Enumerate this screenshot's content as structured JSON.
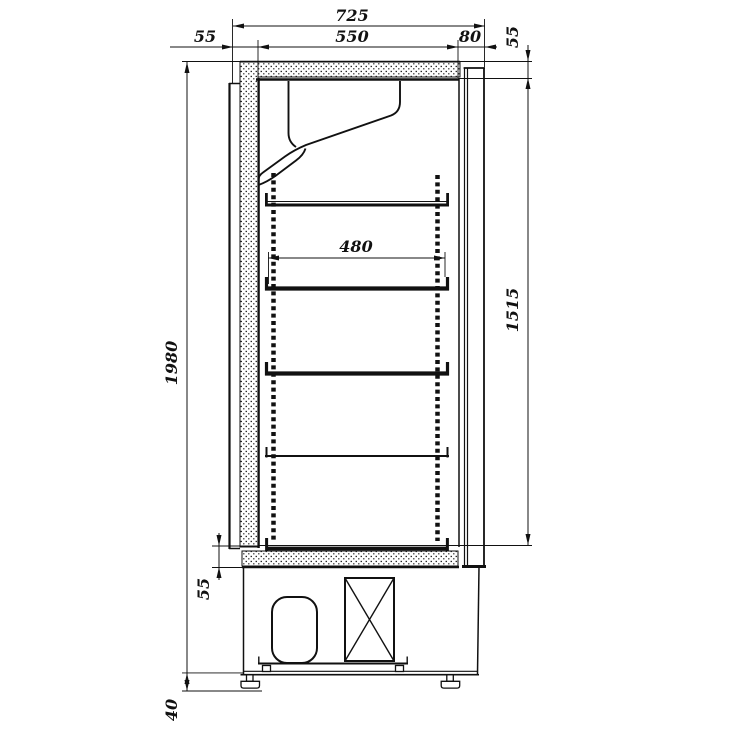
{
  "drawing": {
    "background_color": "#ffffff",
    "line_color": "#111111",
    "dimensions": {
      "overall_depth": "725",
      "interior_depth": "550",
      "rear_duct_depth": "80",
      "front_wall_thickness": "55",
      "top_wall_thickness": "55",
      "shelf_depth": "480",
      "interior_height": "1515",
      "overall_height": "1980",
      "bottom_wall_thickness": "55",
      "feet_height": "40"
    }
  }
}
